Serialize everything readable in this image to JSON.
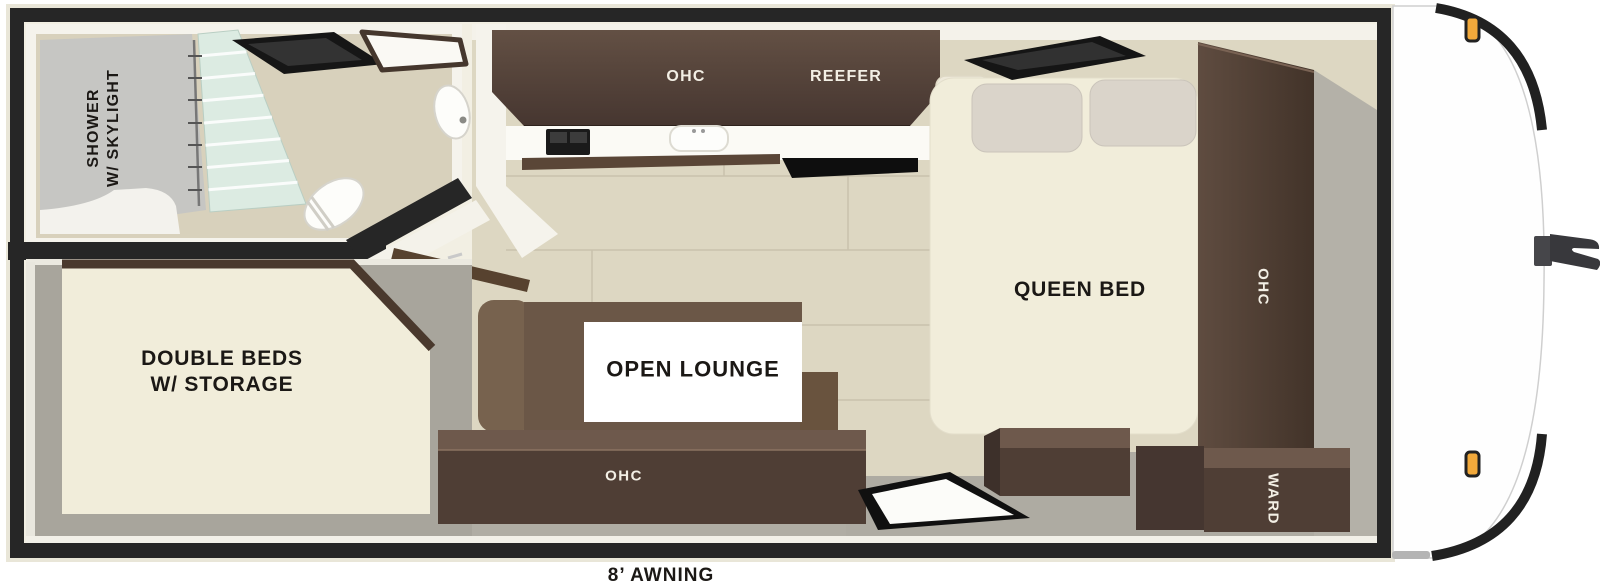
{
  "trailer": {
    "awning_label": "8’ AWNING",
    "bathroom": {
      "shower_label": "SHOWER\nW/ SKYLIGHT"
    },
    "rear_bedroom": {
      "bed_label": "DOUBLE BEDS\nW/ STORAGE"
    },
    "kitchen": {
      "overhead_cabinet_label": "OHC",
      "refrigerator_label": "REEFER"
    },
    "lounge": {
      "label": "OPEN LOUNGE",
      "overhead_cabinet_label": "OHC"
    },
    "front_bedroom": {
      "bed_label": "QUEEN BED",
      "overhead_cabinet_label": "OHC",
      "wardrobe_label": "WARD"
    },
    "colors": {
      "wall_black": "#262626",
      "wood_floor": "#ddd7c2",
      "gray_floor": "#aeaba2",
      "bed_cream": "#f1edda",
      "sofa_brown": "#6b5747",
      "cabinet_front": "#4f3e35",
      "cabinet_top": "#6e594c",
      "shower_glass": "#dcebe2",
      "marker_light_amber": "#f2a93b"
    }
  }
}
